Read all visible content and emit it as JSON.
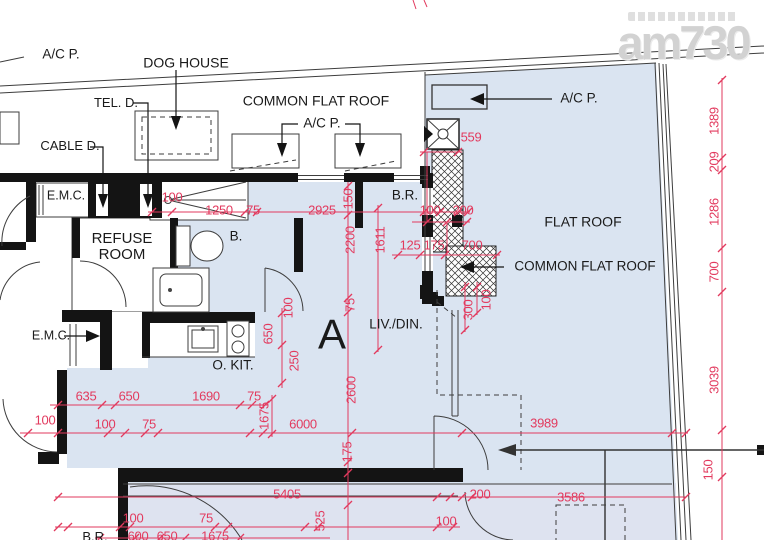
{
  "colors": {
    "dimension_red": "#e23a5e",
    "flat_fill_blue": "#dae4f1",
    "lower_unit_fill": "#dee3f0",
    "wall_black": "#141414",
    "line_gray": "#3d3d3d",
    "watermark_gray": "#d2d2d2"
  },
  "watermark": {
    "logo": "am730"
  },
  "labels": [
    {
      "n": "label-ac-p-top-left",
      "t": "A/C P.",
      "x": 61,
      "y": 55,
      "fs": 13.5
    },
    {
      "n": "label-dog-house",
      "t": "DOG HOUSE",
      "x": 186,
      "y": 63,
      "fs": 14
    },
    {
      "n": "label-tel-d",
      "t": "TEL. D.",
      "x": 116,
      "y": 103,
      "fs": 13
    },
    {
      "n": "label-common-flat-roof-top",
      "t": "COMMON FLAT ROOF",
      "x": 316,
      "y": 101,
      "fs": 14
    },
    {
      "n": "label-ac-p-mid",
      "t": "A/C P.",
      "x": 322,
      "y": 124,
      "fs": 13.5
    },
    {
      "n": "label-cable-d",
      "t": "CABLE D.",
      "x": 70,
      "y": 146,
      "fs": 13
    },
    {
      "n": "label-ac-p-right",
      "t": "A/C P.",
      "x": 579,
      "y": 99,
      "fs": 13.5
    },
    {
      "n": "label-emc-top",
      "t": "E.M.C.",
      "x": 66,
      "y": 196,
      "fs": 12.5
    },
    {
      "n": "label-refuse-room",
      "t": "REFUSE\nROOM",
      "x": 122,
      "y": 247,
      "fs": 15
    },
    {
      "n": "label-bathroom",
      "t": "B.",
      "x": 236,
      "y": 237,
      "fs": 13.5
    },
    {
      "n": "label-bedroom",
      "t": "B.R.",
      "x": 405,
      "y": 196,
      "fs": 13.5
    },
    {
      "n": "label-flat-roof",
      "t": "FLAT ROOF",
      "x": 583,
      "y": 222,
      "fs": 14
    },
    {
      "n": "label-common-flat-roof-right",
      "t": "COMMON FLAT ROOF",
      "x": 585,
      "y": 267,
      "fs": 13.5
    },
    {
      "n": "label-emc-left",
      "t": "E.M.C.",
      "x": 51,
      "y": 336,
      "fs": 12.5
    },
    {
      "n": "label-open-kitchen",
      "t": "O. KIT.",
      "x": 233,
      "y": 366,
      "fs": 13.5
    },
    {
      "n": "label-living-dining",
      "t": "LIV./DIN.",
      "x": 396,
      "y": 325,
      "fs": 13.5
    },
    {
      "n": "label-unit-a",
      "t": "A",
      "x": 332,
      "y": 334,
      "fs": 42
    },
    {
      "n": "label-bedroom-bottom",
      "t": "B.R.",
      "x": 95,
      "y": 537,
      "fs": 13
    }
  ],
  "dimensions": [
    {
      "t": "100",
      "x": 172,
      "y": 197,
      "r": 0
    },
    {
      "t": "1250",
      "x": 219,
      "y": 210,
      "r": 0
    },
    {
      "t": "75",
      "x": 253,
      "y": 210,
      "r": 0
    },
    {
      "t": "2925",
      "x": 322,
      "y": 210,
      "r": 0
    },
    {
      "t": "100",
      "x": 430,
      "y": 210,
      "r": 0
    },
    {
      "t": "200",
      "x": 463,
      "y": 210,
      "r": 0
    },
    {
      "t": "559",
      "x": 471,
      "y": 137,
      "r": 0
    },
    {
      "t": "125",
      "x": 410,
      "y": 245,
      "r": 0
    },
    {
      "t": "175",
      "x": 434,
      "y": 245,
      "r": 0
    },
    {
      "t": "700",
      "x": 472,
      "y": 245,
      "r": 0
    },
    {
      "t": "635",
      "x": 86,
      "y": 396,
      "r": 0
    },
    {
      "t": "650",
      "x": 129,
      "y": 396,
      "r": 0
    },
    {
      "t": "1690",
      "x": 206,
      "y": 396,
      "r": 0
    },
    {
      "t": "75",
      "x": 254,
      "y": 396,
      "r": 0
    },
    {
      "t": "100",
      "x": 45,
      "y": 420,
      "r": 0
    },
    {
      "t": "100",
      "x": 105,
      "y": 424,
      "r": 0
    },
    {
      "t": "75",
      "x": 149,
      "y": 424,
      "r": 0
    },
    {
      "t": "6000",
      "x": 303,
      "y": 424,
      "r": 0
    },
    {
      "t": "3989",
      "x": 544,
      "y": 423,
      "r": 0
    },
    {
      "t": "5405",
      "x": 287,
      "y": 494,
      "r": 0
    },
    {
      "t": "200",
      "x": 480,
      "y": 494,
      "r": 0
    },
    {
      "t": "3586",
      "x": 571,
      "y": 497,
      "r": 0
    },
    {
      "t": "100",
      "x": 446,
      "y": 521,
      "r": 0
    },
    {
      "t": "100",
      "x": 133,
      "y": 518,
      "r": 0
    },
    {
      "t": "75",
      "x": 206,
      "y": 518,
      "r": 0
    },
    {
      "t": "600",
      "x": 138,
      "y": 536,
      "r": 0
    },
    {
      "t": "650",
      "x": 167,
      "y": 536,
      "r": 0
    },
    {
      "t": "1675",
      "x": 215,
      "y": 536,
      "r": 0
    },
    {
      "t": "150",
      "x": 348,
      "y": 199,
      "r": 1
    },
    {
      "t": "2200",
      "x": 350,
      "y": 240,
      "r": 1
    },
    {
      "t": "1611",
      "x": 380,
      "y": 240,
      "r": 1
    },
    {
      "t": "75",
      "x": 350,
      "y": 305,
      "r": 1
    },
    {
      "t": "100",
      "x": 288,
      "y": 308,
      "r": 1
    },
    {
      "t": "650",
      "x": 268,
      "y": 334,
      "r": 1
    },
    {
      "t": "250",
      "x": 294,
      "y": 361,
      "r": 1
    },
    {
      "t": "2600",
      "x": 351,
      "y": 390,
      "r": 1
    },
    {
      "t": "1675",
      "x": 264,
      "y": 416,
      "r": 1
    },
    {
      "t": "175",
      "x": 347,
      "y": 452,
      "r": 1
    },
    {
      "t": "300",
      "x": 468,
      "y": 310,
      "r": 1
    },
    {
      "t": "100",
      "x": 486,
      "y": 300,
      "r": 1
    },
    {
      "t": "525",
      "x": 320,
      "y": 521,
      "r": 1
    },
    {
      "t": "1389",
      "x": 714,
      "y": 121,
      "r": 1
    },
    {
      "t": "209",
      "x": 714,
      "y": 162,
      "r": 1
    },
    {
      "t": "1286",
      "x": 714,
      "y": 212,
      "r": 1
    },
    {
      "t": "700",
      "x": 714,
      "y": 272,
      "r": 1
    },
    {
      "t": "3039",
      "x": 714,
      "y": 380,
      "r": 1
    },
    {
      "t": "150",
      "x": 708,
      "y": 470,
      "r": 1
    }
  ]
}
